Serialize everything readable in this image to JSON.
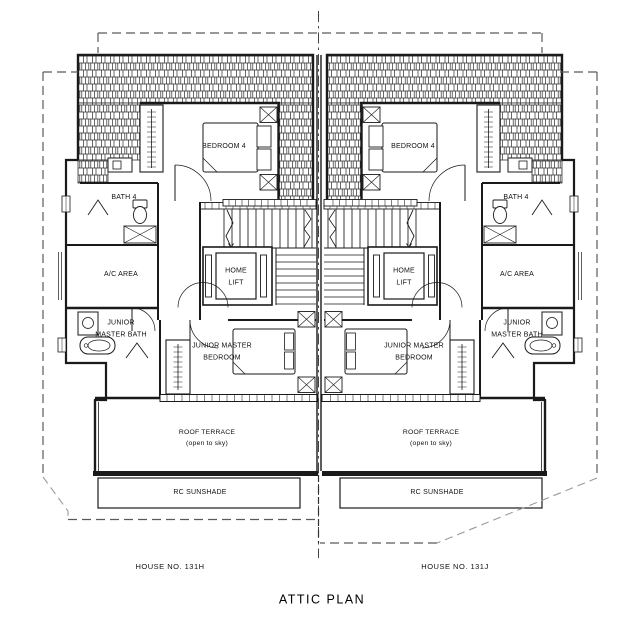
{
  "plan": {
    "title": "ATTIC PLAN",
    "labels": {
      "bedroom4": "BEDROOM 4",
      "bath4": "BATH 4",
      "ac_area": "A/C AREA",
      "home_lift": "HOME\nLIFT",
      "junior_master_bath": "JUNIOR\nMASTER BATH",
      "junior_master_bedroom": "JUNIOR MASTER\nBEDROOM",
      "roof_terrace": "ROOF TERRACE\n(open to sky)",
      "rc_sunshade": "RC SUNSHADE"
    },
    "houses": [
      {
        "name": "HOUSE NO. 131H"
      },
      {
        "name": "HOUSE NO. 131J"
      }
    ],
    "colors": {
      "line": "#1a1a1a",
      "boundary": "#5a5a5a",
      "background": "#ffffff"
    }
  }
}
